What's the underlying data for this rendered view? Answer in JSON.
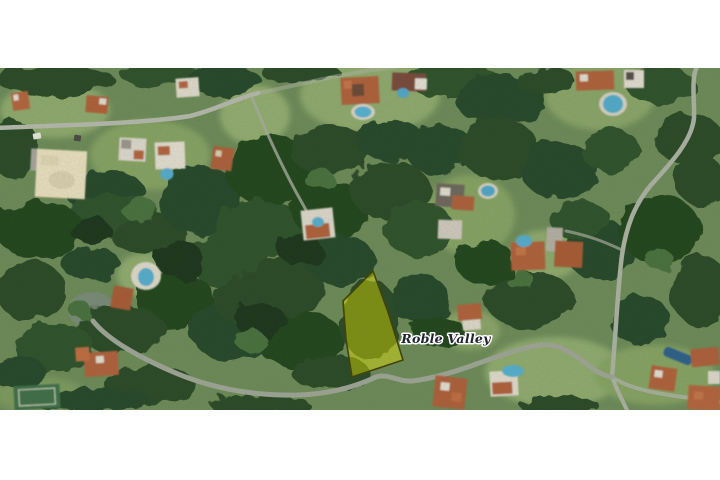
{
  "image": {
    "description": "Aerial satellite photo of a wooded residential neighborhood with winding roads, houses with pools, and a highlighted vacant lot",
    "label": "Roble Valley",
    "label_color": "#20242f",
    "parcel": {
      "points": "373,271 388,312 403,360 352,377 346,339 343,301",
      "fill": "#e8e800",
      "fill_opacity": "0.42",
      "stroke": "#43430a",
      "stroke_width": "1.6"
    }
  }
}
